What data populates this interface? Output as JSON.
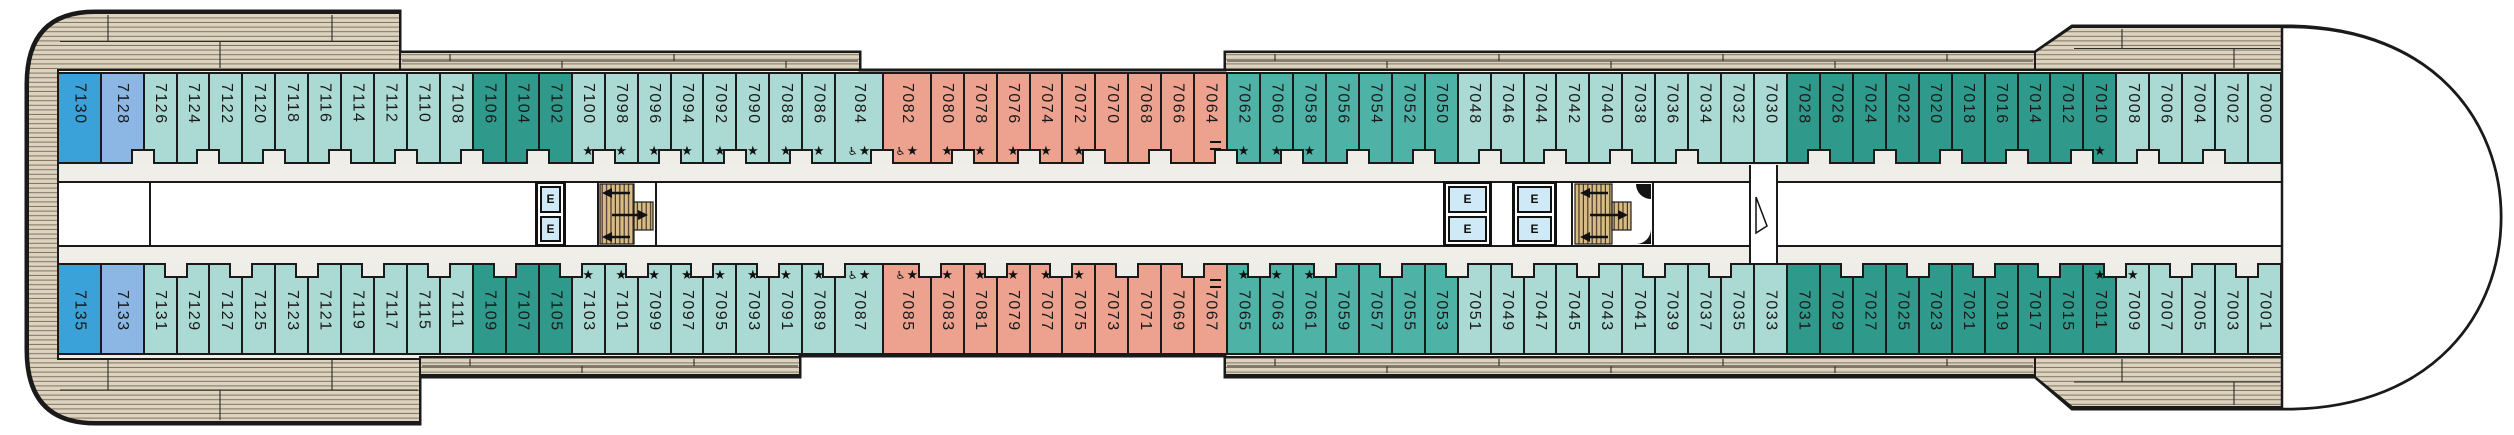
{
  "deck_plan": {
    "description": "cruise-ship cabin deck plan, two cabin rows flanking a central corridor",
    "cabin_categories": {
      "blue": "#3ba2d9",
      "periwinkle": "#8cb7e5",
      "light": "#abd9d3",
      "medium": "#4fb2a7",
      "dark": "#2f9a8b",
      "salmon": "#eca28f"
    }
  },
  "symbols": {
    "star": "★",
    "accessible": "♿",
    "elevator": "E"
  },
  "facilities": {
    "elevator_label": "E"
  },
  "cabins": {
    "top_row": [
      {
        "n": "7130",
        "c": "blue"
      },
      {
        "n": "7128",
        "c": "periwinkle"
      },
      {
        "n": "7126",
        "c": "light"
      },
      {
        "n": "7124",
        "c": "light"
      },
      {
        "n": "7122",
        "c": "light"
      },
      {
        "n": "7120",
        "c": "light"
      },
      {
        "n": "7118",
        "c": "light"
      },
      {
        "n": "7116",
        "c": "light"
      },
      {
        "n": "7114",
        "c": "light"
      },
      {
        "n": "7112",
        "c": "light"
      },
      {
        "n": "7110",
        "c": "light"
      },
      {
        "n": "7108",
        "c": "light"
      },
      {
        "n": "7106",
        "c": "dark"
      },
      {
        "n": "7104",
        "c": "dark"
      },
      {
        "n": "7102",
        "c": "dark"
      },
      {
        "n": "7100",
        "c": "light",
        "s": true
      },
      {
        "n": "7098",
        "c": "light",
        "s": true
      },
      {
        "n": "7096",
        "c": "light",
        "s": true
      },
      {
        "n": "7094",
        "c": "light",
        "s": true
      },
      {
        "n": "7092",
        "c": "light",
        "s": true
      },
      {
        "n": "7090",
        "c": "light",
        "s": true
      },
      {
        "n": "7088",
        "c": "light",
        "s": true
      },
      {
        "n": "7086",
        "c": "light",
        "s": true
      },
      {
        "n": "7084",
        "c": "light",
        "s": true,
        "a": true
      },
      {
        "n": "7082",
        "c": "salmon",
        "s": true,
        "a": true
      },
      {
        "n": "7080",
        "c": "salmon",
        "s": true
      },
      {
        "n": "7078",
        "c": "salmon",
        "s": true
      },
      {
        "n": "7076",
        "c": "salmon",
        "s": true
      },
      {
        "n": "7074",
        "c": "salmon",
        "s": true
      },
      {
        "n": "7072",
        "c": "salmon",
        "s": true
      },
      {
        "n": "7070",
        "c": "salmon"
      },
      {
        "n": "7068",
        "c": "salmon"
      },
      {
        "n": "7066",
        "c": "salmon"
      },
      {
        "n": "7064",
        "c": "salmon"
      },
      {
        "n": "7062",
        "c": "medium",
        "s": true
      },
      {
        "n": "7060",
        "c": "medium",
        "s": true
      },
      {
        "n": "7058",
        "c": "medium",
        "s": true
      },
      {
        "n": "7056",
        "c": "medium"
      },
      {
        "n": "7054",
        "c": "medium"
      },
      {
        "n": "7052",
        "c": "medium"
      },
      {
        "n": "7050",
        "c": "medium"
      },
      {
        "n": "7048",
        "c": "light"
      },
      {
        "n": "7046",
        "c": "light"
      },
      {
        "n": "7044",
        "c": "light"
      },
      {
        "n": "7042",
        "c": "light"
      },
      {
        "n": "7040",
        "c": "light"
      },
      {
        "n": "7038",
        "c": "light"
      },
      {
        "n": "7036",
        "c": "light"
      },
      {
        "n": "7034",
        "c": "light"
      },
      {
        "n": "7032",
        "c": "light"
      },
      {
        "n": "7030",
        "c": "light"
      },
      {
        "n": "7028",
        "c": "dark"
      },
      {
        "n": "7026",
        "c": "dark"
      },
      {
        "n": "7024",
        "c": "dark"
      },
      {
        "n": "7022",
        "c": "dark"
      },
      {
        "n": "7020",
        "c": "dark"
      },
      {
        "n": "7018",
        "c": "dark"
      },
      {
        "n": "7016",
        "c": "dark"
      },
      {
        "n": "7014",
        "c": "dark"
      },
      {
        "n": "7012",
        "c": "dark"
      },
      {
        "n": "7010",
        "c": "dark",
        "s": true
      },
      {
        "n": "7008",
        "c": "light"
      },
      {
        "n": "7006",
        "c": "light"
      },
      {
        "n": "7004",
        "c": "light"
      },
      {
        "n": "7002",
        "c": "light"
      },
      {
        "n": "7000",
        "c": "light"
      }
    ],
    "bottom_row": [
      {
        "n": "7135",
        "c": "blue"
      },
      {
        "n": "7133",
        "c": "periwinkle"
      },
      {
        "n": "7131",
        "c": "light"
      },
      {
        "n": "7129",
        "c": "light"
      },
      {
        "n": "7127",
        "c": "light"
      },
      {
        "n": "7125",
        "c": "light"
      },
      {
        "n": "7123",
        "c": "light"
      },
      {
        "n": "7121",
        "c": "light"
      },
      {
        "n": "7119",
        "c": "light"
      },
      {
        "n": "7117",
        "c": "light"
      },
      {
        "n": "7115",
        "c": "light"
      },
      {
        "n": "7111",
        "c": "light"
      },
      {
        "n": "7109",
        "c": "dark"
      },
      {
        "n": "7107",
        "c": "dark"
      },
      {
        "n": "7105",
        "c": "dark"
      },
      {
        "n": "7103",
        "c": "light",
        "s": true
      },
      {
        "n": "7101",
        "c": "light",
        "s": true
      },
      {
        "n": "7099",
        "c": "light",
        "s": true
      },
      {
        "n": "7097",
        "c": "light",
        "s": true
      },
      {
        "n": "7095",
        "c": "light",
        "s": true
      },
      {
        "n": "7093",
        "c": "light",
        "s": true
      },
      {
        "n": "7091",
        "c": "light",
        "s": true
      },
      {
        "n": "7089",
        "c": "light",
        "s": true
      },
      {
        "n": "7087",
        "c": "light",
        "s": true,
        "a": true
      },
      {
        "n": "7085",
        "c": "salmon",
        "s": true,
        "a": true
      },
      {
        "n": "7083",
        "c": "salmon",
        "s": true
      },
      {
        "n": "7081",
        "c": "salmon",
        "s": true
      },
      {
        "n": "7079",
        "c": "salmon",
        "s": true
      },
      {
        "n": "7077",
        "c": "salmon",
        "s": true
      },
      {
        "n": "7075",
        "c": "salmon",
        "s": true
      },
      {
        "n": "7073",
        "c": "salmon"
      },
      {
        "n": "7071",
        "c": "salmon"
      },
      {
        "n": "7069",
        "c": "salmon"
      },
      {
        "n": "7067",
        "c": "salmon"
      },
      {
        "n": "7065",
        "c": "medium",
        "s": true
      },
      {
        "n": "7063",
        "c": "medium",
        "s": true
      },
      {
        "n": "7061",
        "c": "medium",
        "s": true
      },
      {
        "n": "7059",
        "c": "medium"
      },
      {
        "n": "7057",
        "c": "medium"
      },
      {
        "n": "7055",
        "c": "medium"
      },
      {
        "n": "7053",
        "c": "medium"
      },
      {
        "n": "7051",
        "c": "light"
      },
      {
        "n": "7049",
        "c": "light"
      },
      {
        "n": "7047",
        "c": "light"
      },
      {
        "n": "7045",
        "c": "light"
      },
      {
        "n": "7043",
        "c": "light"
      },
      {
        "n": "7041",
        "c": "light"
      },
      {
        "n": "7039",
        "c": "light"
      },
      {
        "n": "7037",
        "c": "light"
      },
      {
        "n": "7035",
        "c": "light"
      },
      {
        "n": "7033",
        "c": "light"
      },
      {
        "n": "7031",
        "c": "dark"
      },
      {
        "n": "7029",
        "c": "dark"
      },
      {
        "n": "7027",
        "c": "dark"
      },
      {
        "n": "7025",
        "c": "dark"
      },
      {
        "n": "7023",
        "c": "dark"
      },
      {
        "n": "7021",
        "c": "dark"
      },
      {
        "n": "7019",
        "c": "dark"
      },
      {
        "n": "7017",
        "c": "dark"
      },
      {
        "n": "7015",
        "c": "dark"
      },
      {
        "n": "7011",
        "c": "dark",
        "s": true
      },
      {
        "n": "7009",
        "c": "light",
        "s": true
      },
      {
        "n": "7007",
        "c": "light"
      },
      {
        "n": "7005",
        "c": "light"
      },
      {
        "n": "7003",
        "c": "light"
      },
      {
        "n": "7001",
        "c": "light"
      }
    ]
  }
}
